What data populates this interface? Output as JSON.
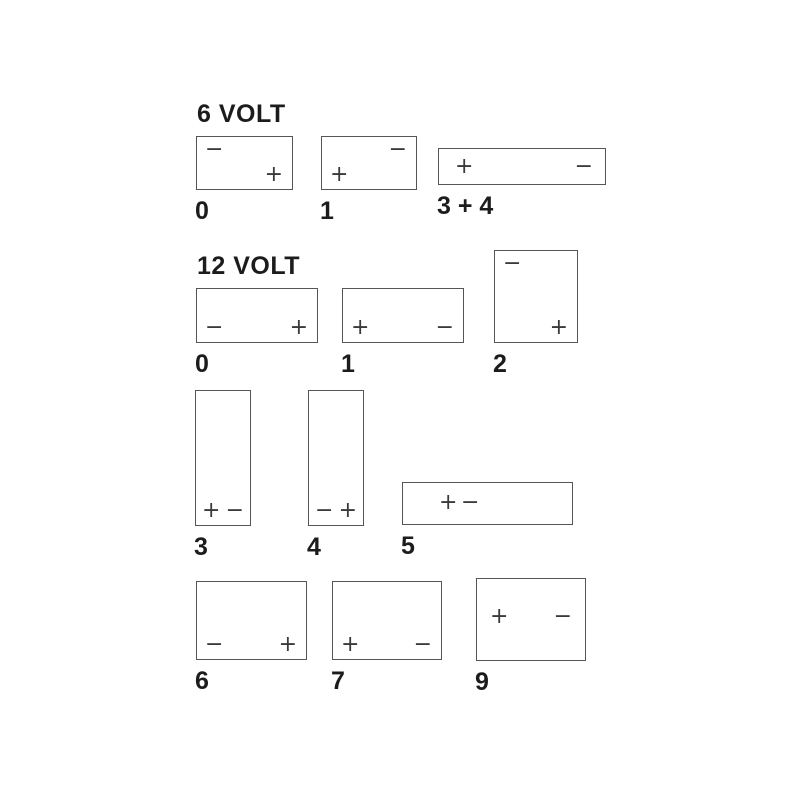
{
  "page": {
    "background": "#ffffff",
    "line_color": "#555555",
    "symbol_color": "#3a3a3a",
    "text_color": "#1c1c1c"
  },
  "diagram_title": "Battery terminal layout codes",
  "sections": [
    {
      "title": "6 VOLT",
      "title_pos": {
        "x": 197,
        "y": 100
      },
      "boxes": [
        {
          "label": "0",
          "x": 196,
          "y": 136,
          "w": 97,
          "h": 54,
          "terminals": [
            {
              "symbol": "−",
              "polarity": "negative",
              "pos": "top-left"
            },
            {
              "symbol": "+",
              "polarity": "positive",
              "pos": "bottom-right"
            }
          ]
        },
        {
          "label": "1",
          "x": 321,
          "y": 136,
          "w": 96,
          "h": 54,
          "terminals": [
            {
              "symbol": "−",
              "polarity": "negative",
              "pos": "top-right"
            },
            {
              "symbol": "+",
              "polarity": "positive",
              "pos": "bottom-left"
            }
          ]
        },
        {
          "label": "3 + 4",
          "x": 438,
          "y": 148,
          "w": 168,
          "h": 37,
          "terminals": [
            {
              "symbol": "+",
              "polarity": "positive",
              "pos": "mid-left"
            },
            {
              "symbol": "−",
              "polarity": "negative",
              "pos": "mid-right"
            }
          ]
        }
      ]
    },
    {
      "title": "12 VOLT",
      "title_pos": {
        "x": 197,
        "y": 252
      },
      "boxes": [
        {
          "label": "0",
          "x": 196,
          "y": 288,
          "w": 122,
          "h": 55,
          "terminals": [
            {
              "symbol": "−",
              "polarity": "negative",
              "pos": "bottom-left"
            },
            {
              "symbol": "+",
              "polarity": "positive",
              "pos": "bottom-right"
            }
          ]
        },
        {
          "label": "1",
          "x": 342,
          "y": 288,
          "w": 122,
          "h": 55,
          "terminals": [
            {
              "symbol": "+",
              "polarity": "positive",
              "pos": "bottom-left"
            },
            {
              "symbol": "−",
              "polarity": "negative",
              "pos": "bottom-right"
            }
          ]
        },
        {
          "label": "2",
          "x": 494,
          "y": 250,
          "w": 84,
          "h": 93,
          "terminals": [
            {
              "symbol": "−",
              "polarity": "negative",
              "pos": "top-left"
            },
            {
              "symbol": "+",
              "polarity": "positive",
              "pos": "bottom-right"
            }
          ]
        },
        {
          "label": "3",
          "x": 195,
          "y": 390,
          "w": 56,
          "h": 136,
          "terminals": [
            {
              "symbol": "+",
              "polarity": "positive",
              "pos": "custom",
              "left": "6px",
              "bottom": "2px"
            },
            {
              "symbol": "−",
              "polarity": "negative",
              "pos": "custom",
              "right": "6px",
              "bottom": "2px"
            }
          ]
        },
        {
          "label": "4",
          "x": 308,
          "y": 390,
          "w": 56,
          "h": 136,
          "terminals": [
            {
              "symbol": "−",
              "polarity": "negative",
              "pos": "custom",
              "left": "6px",
              "bottom": "2px"
            },
            {
              "symbol": "+",
              "polarity": "positive",
              "pos": "custom",
              "right": "6px",
              "bottom": "2px"
            }
          ]
        },
        {
          "label": "5",
          "x": 402,
          "y": 482,
          "w": 171,
          "h": 43,
          "terminals": [
            {
              "symbol": "+",
              "polarity": "positive",
              "pos": "custom",
              "left": "36px",
              "top": "8px"
            },
            {
              "symbol": "−",
              "polarity": "negative",
              "pos": "custom",
              "left": "58px",
              "top": "8px"
            }
          ]
        },
        {
          "label": "6",
          "x": 196,
          "y": 581,
          "w": 111,
          "h": 79,
          "terminals": [
            {
              "symbol": "−",
              "polarity": "negative",
              "pos": "bottom-left"
            },
            {
              "symbol": "+",
              "polarity": "positive",
              "pos": "bottom-right"
            }
          ]
        },
        {
          "label": "7",
          "x": 332,
          "y": 581,
          "w": 110,
          "h": 79,
          "terminals": [
            {
              "symbol": "+",
              "polarity": "positive",
              "pos": "bottom-left"
            },
            {
              "symbol": "−",
              "polarity": "negative",
              "pos": "bottom-right"
            }
          ]
        },
        {
          "label": "9",
          "x": 476,
          "y": 578,
          "w": 110,
          "h": 83,
          "terminals": [
            {
              "symbol": "+",
              "polarity": "positive",
              "pos": "custom",
              "left": "13px",
              "top": "26px"
            },
            {
              "symbol": "−",
              "polarity": "negative",
              "pos": "custom",
              "right": "13px",
              "top": "26px"
            }
          ]
        }
      ]
    }
  ]
}
